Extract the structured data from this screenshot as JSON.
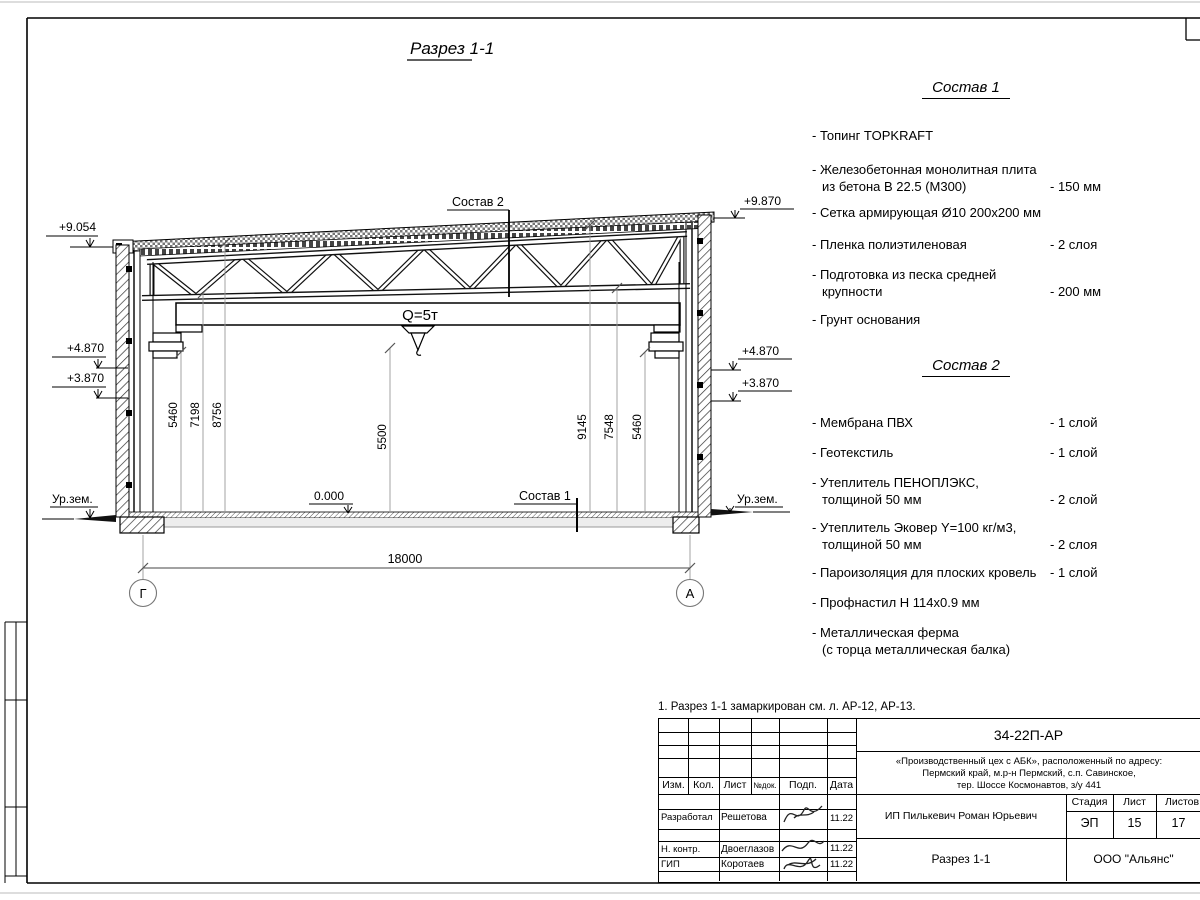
{
  "page": {
    "title": "Разрез 1-1",
    "note": "1. Разрез 1-1 замаркирован см. л. АР-12, АР-13."
  },
  "drawing": {
    "elevations": {
      "left_top": "+9.054",
      "left_mid": "+4.870",
      "left_low": "+3.870",
      "left_ground": "Ур.зем.",
      "right_top": "+9.870",
      "right_mid": "+4.870",
      "right_low": "+3.870",
      "right_ground": "Ур.зем.",
      "floor": "0.000"
    },
    "callouts": {
      "sostav2": "Состав 2",
      "sostav1": "Состав 1",
      "crane": "Q=5т"
    },
    "dims": {
      "left": [
        "5460",
        "7198",
        "8756"
      ],
      "center": "5500",
      "right": [
        "9145",
        "7548",
        "5460"
      ],
      "span": "18000"
    },
    "grid": {
      "left": "Г",
      "right": "А"
    }
  },
  "sostav1": {
    "title": "Состав 1",
    "items": [
      {
        "line1": "- Топинг TOPKRAFT",
        "line2": "",
        "value": ""
      },
      {
        "line1": "- Железобетонная  монолитная плита",
        "line2": "из бетона В 22.5 (М300)",
        "value": "- 150 мм"
      },
      {
        "line1": "- Сетка армирующая Ø10 200х200 мм",
        "line2": "",
        "value": ""
      },
      {
        "line1": "- Пленка полиэтиленовая",
        "line2": "",
        "value": "-  2 слоя"
      },
      {
        "line1": "- Подготовка из песка средней",
        "line2": "крупности",
        "value": "- 200 мм"
      },
      {
        "line1": "- Грунт основания",
        "line2": "",
        "value": ""
      }
    ]
  },
  "sostav2": {
    "title": "Состав 2",
    "items": [
      {
        "line1": "- Мембрана ПВХ",
        "line2": "",
        "value": "- 1 слой"
      },
      {
        "line1": "- Геотекстиль",
        "line2": "",
        "value": "- 1 слой"
      },
      {
        "line1": "- Утеплитель ПЕНОПЛЭКС,",
        "line2": "толщиной 50 мм",
        "value": "- 2 слой"
      },
      {
        "line1": "- Утеплитель Эковер Y=100 кг/м3,",
        "line2": "толщиной 50 мм",
        "value": "- 2 слоя"
      },
      {
        "line1": "- Пароизоляция для плоских кровель",
        "line2": "",
        "value": "- 1 слой"
      },
      {
        "line1": "- Профнастил Н 114х0.9 мм",
        "line2": "",
        "value": ""
      },
      {
        "line1": "- Металлическая ферма",
        "line2": "(с торца металлическая балка)",
        "value": ""
      }
    ]
  },
  "titleblock": {
    "code": "34-22П-АР",
    "project": [
      "«Производственный цех с АБК», расположенный по адресу:",
      "Пермский край, м.р-н Пермский, с.п. Савинское,",
      "тер. Шоссе Космонавтов, з/у 441"
    ],
    "headers": {
      "izm": "Изм.",
      "kol": "Кол.",
      "list": "Лист",
      "ndok": "№док.",
      "podp": "Подп.",
      "data": "Дата"
    },
    "rows": [
      {
        "role": "Разработал",
        "name": "Решетова",
        "date": "11.22"
      },
      {
        "role": "Н. контр.",
        "name": "Двоеглазов",
        "date": "11.22"
      },
      {
        "role": "ГИП",
        "name": "Коротаев",
        "date": "11.22"
      }
    ],
    "client": "ИП Пилькевич Роман Юрьевич",
    "stage_label": "Стадия",
    "sheet_label": "Лист",
    "sheets_label": "Листов",
    "stage": "ЭП",
    "sheet": "15",
    "sheets": "17",
    "drawing_title": "Разрез 1-1",
    "company": "ООО \"Альянс\""
  }
}
